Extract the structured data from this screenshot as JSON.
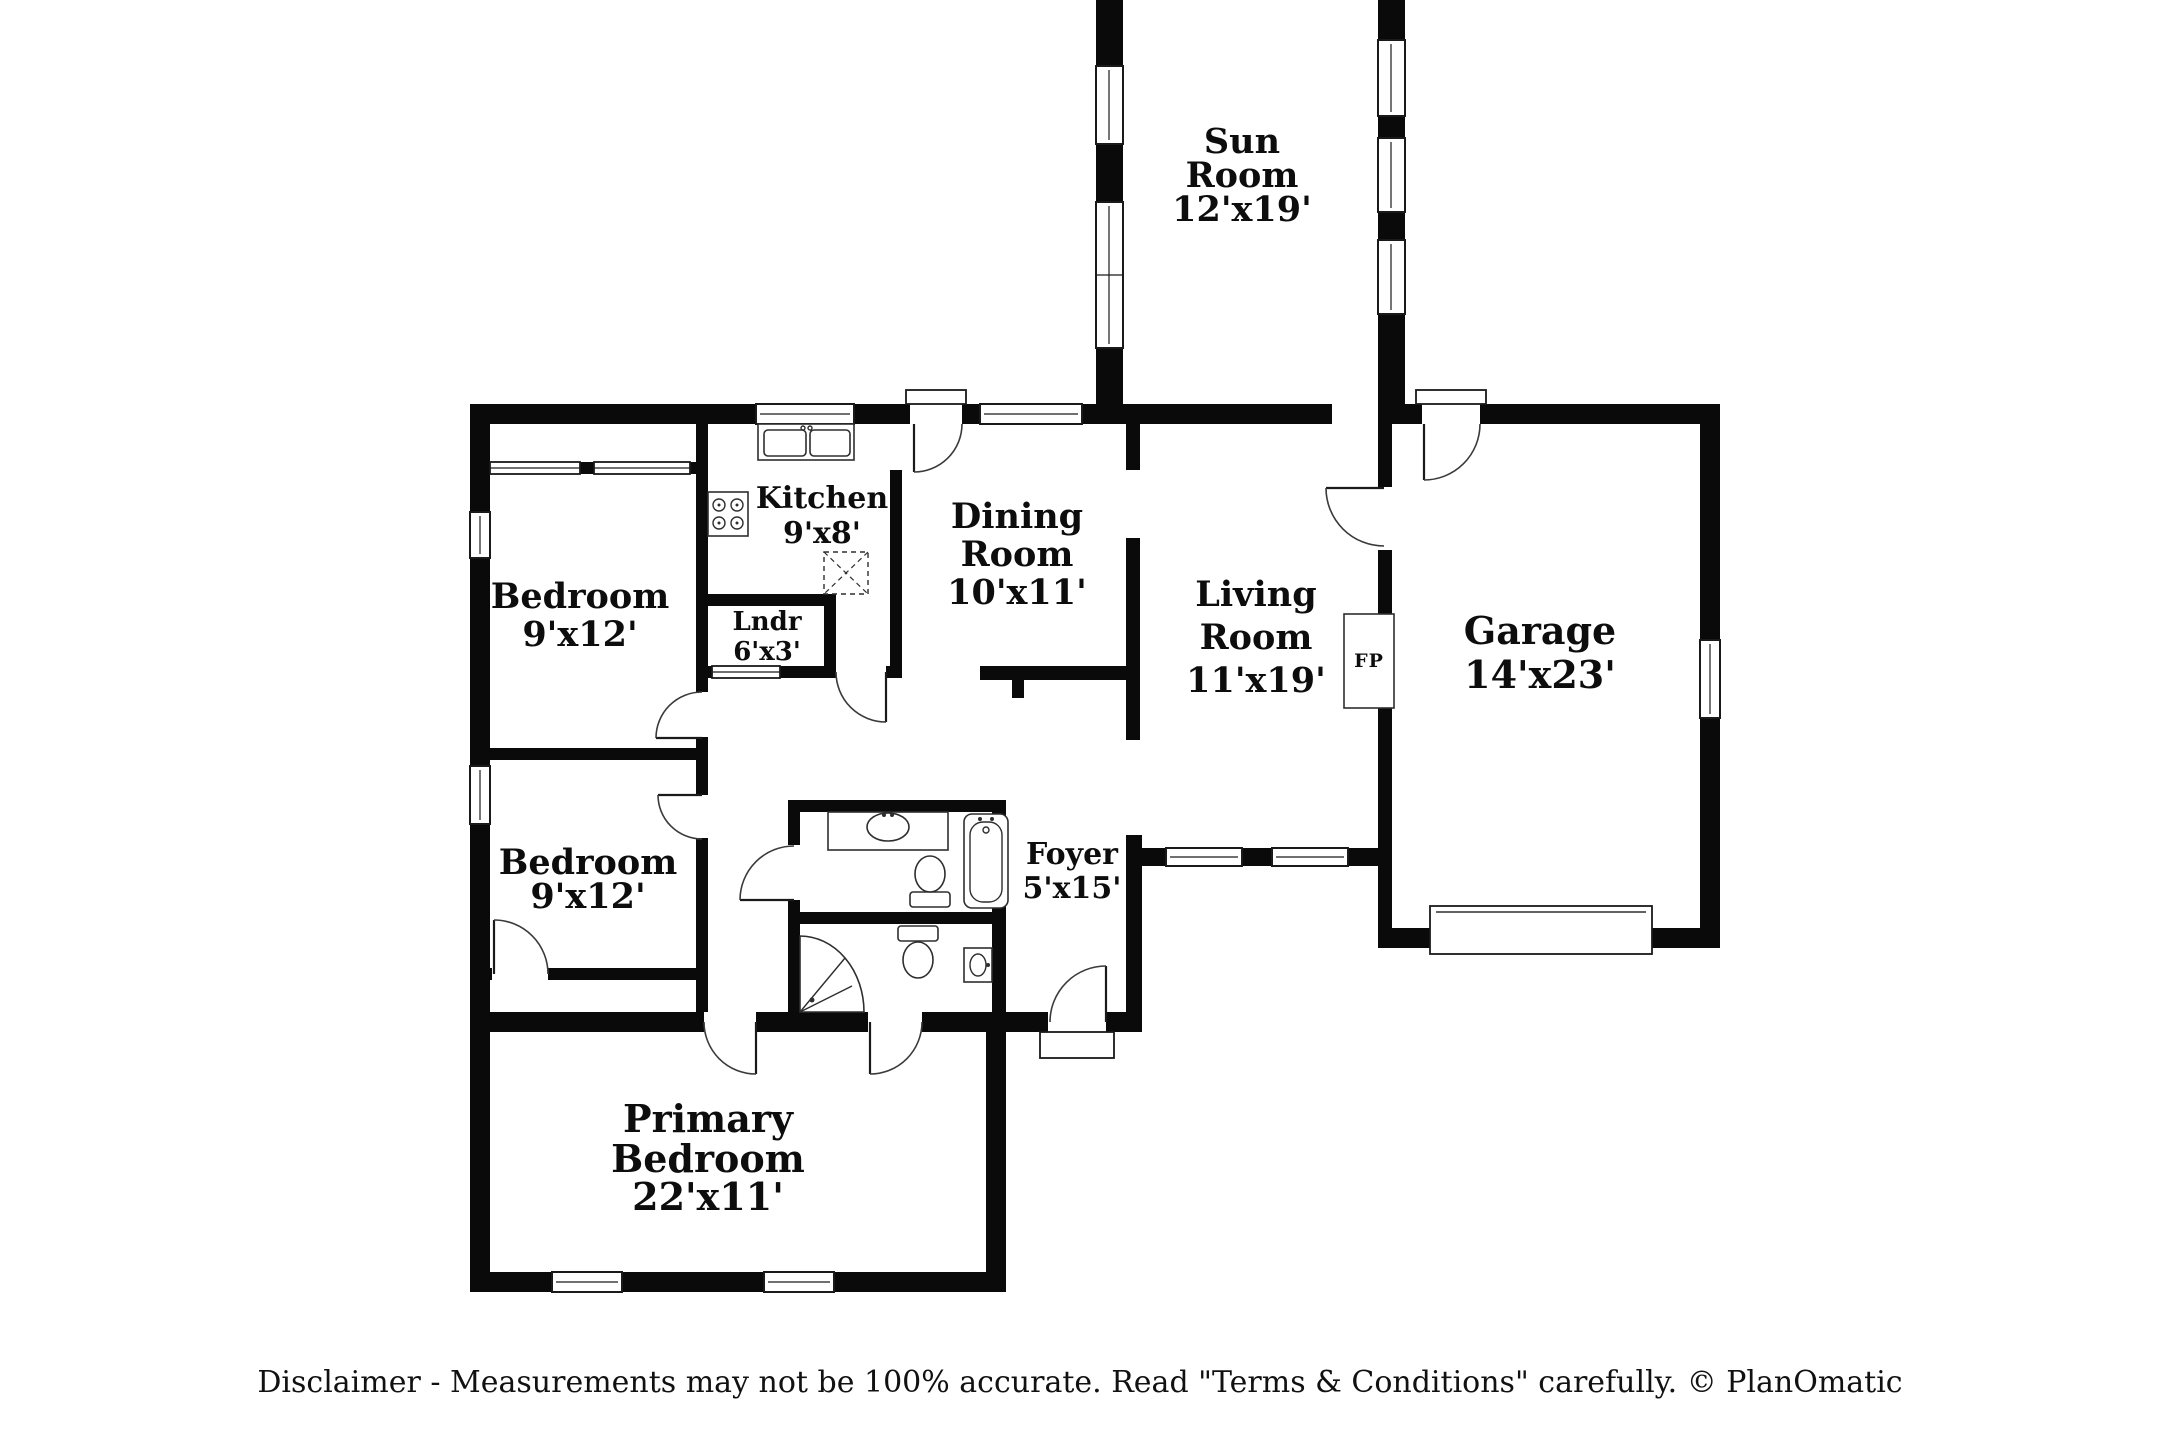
{
  "floor_plan": {
    "rooms": [
      {
        "id": "sun-room",
        "name": "Sun Room",
        "dimensions": "12'x19'",
        "lines": [
          "Sun",
          "Room",
          "12'x19'"
        ]
      },
      {
        "id": "kitchen",
        "name": "Kitchen",
        "dimensions": "9'x8'",
        "lines": [
          "Kitchen",
          "9'x8'"
        ]
      },
      {
        "id": "dining-room",
        "name": "Dining Room",
        "dimensions": "10'x11'",
        "lines": [
          "Dining",
          "Room",
          "10'x11'"
        ]
      },
      {
        "id": "living-room",
        "name": "Living Room",
        "dimensions": "11'x19'",
        "lines": [
          "Living",
          "Room",
          "11'x19'"
        ]
      },
      {
        "id": "garage",
        "name": "Garage",
        "dimensions": "14'x23'",
        "lines": [
          "Garage",
          "14'x23'"
        ]
      },
      {
        "id": "bedroom-1",
        "name": "Bedroom",
        "dimensions": "9'x12'",
        "lines": [
          "Bedroom",
          "9'x12'"
        ]
      },
      {
        "id": "bedroom-2",
        "name": "Bedroom",
        "dimensions": "9'x12'",
        "lines": [
          "Bedroom",
          "9'x12'"
        ]
      },
      {
        "id": "laundry",
        "name": "Lndr",
        "dimensions": "6'x3'",
        "lines": [
          "Lndr",
          "6'x3'"
        ]
      },
      {
        "id": "foyer",
        "name": "Foyer",
        "dimensions": "5'x15'",
        "lines": [
          "Foyer",
          "5'x15'"
        ]
      },
      {
        "id": "primary-bedroom",
        "name": "Primary Bedroom",
        "dimensions": "22'x11'",
        "lines": [
          "Primary",
          "Bedroom",
          "22'x11'"
        ]
      }
    ],
    "fireplace_label": "FP"
  },
  "footer": {
    "disclaimer": "Disclaimer - Measurements may not be 100% accurate. Read \"Terms & Conditions\" carefully. © PlanOmatic"
  },
  "colors": {
    "walls": "#0a0a0a",
    "background": "#ffffff"
  }
}
